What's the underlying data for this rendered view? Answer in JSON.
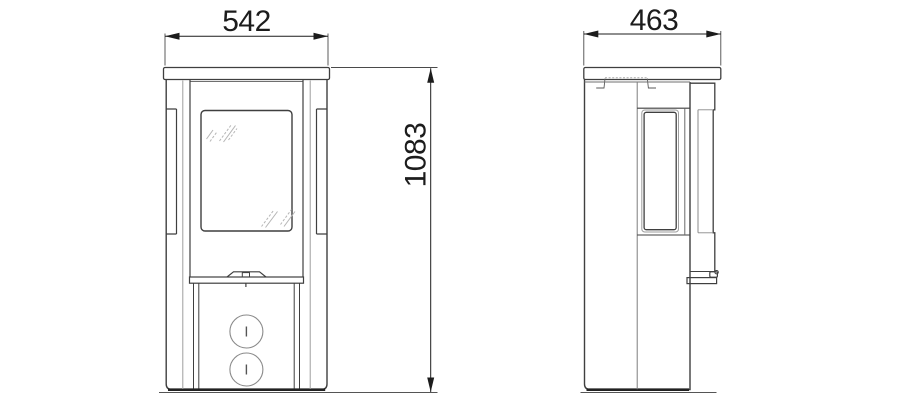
{
  "drawing": {
    "background": "#ffffff",
    "line_color": "#3f3f3f",
    "thin_line_color": "#9e9e9e",
    "glass_mark_color": "#b5b5b5",
    "dim_color": "#1c1c1c",
    "dimensions": {
      "width": "542",
      "depth": "463",
      "height": "1083"
    }
  }
}
